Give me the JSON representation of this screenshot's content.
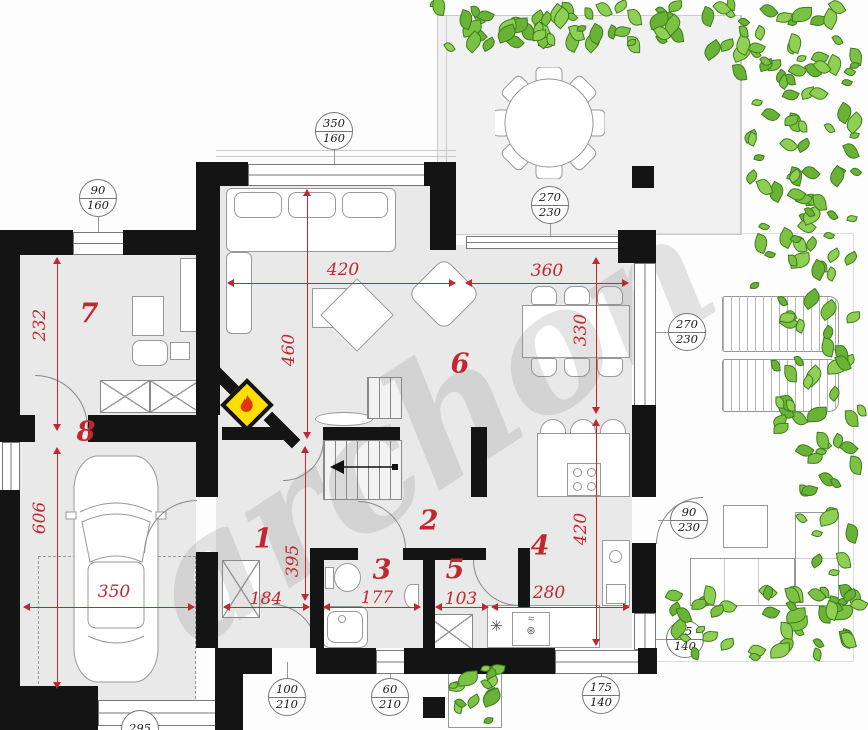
{
  "title": "House ground-floor plan",
  "watermark": "archon",
  "colors": {
    "accent_red": "#c22730",
    "wall_black": "#141414",
    "room_fill": "#e9e9e9",
    "terrace_fill": "#f1f1f1",
    "plant_green": "#7cc242",
    "plant_dark": "#3e7c1c",
    "fireplace_yellow": "#ffdf00",
    "flame_red": "#e03616",
    "line_gray": "#8a8a8a"
  },
  "room_labels": [
    {
      "n": "1",
      "x": 263,
      "y": 539
    },
    {
      "n": "2",
      "x": 429,
      "y": 521
    },
    {
      "n": "3",
      "x": 382,
      "y": 570
    },
    {
      "n": "4",
      "x": 540,
      "y": 546
    },
    {
      "n": "5",
      "x": 455,
      "y": 570
    },
    {
      "n": "6",
      "x": 460,
      "y": 364
    },
    {
      "n": "7",
      "x": 89,
      "y": 314
    },
    {
      "n": "8",
      "x": 86,
      "y": 432
    }
  ],
  "red_dims": [
    {
      "text": "420",
      "tx": 343,
      "ty": 270,
      "rot": 0,
      "dir": "h",
      "lx": 228,
      "ly": 283,
      "ll": 227
    },
    {
      "text": "460",
      "tx": 289,
      "ty": 350,
      "rot": -90,
      "dir": "v",
      "lx": 307,
      "ly": 190,
      "ll": 248
    },
    {
      "text": "360",
      "tx": 547,
      "ty": 271,
      "rot": 0,
      "dir": "h",
      "lx": 466,
      "ly": 283,
      "ll": 162
    },
    {
      "text": "330",
      "tx": 581,
      "ty": 330,
      "rot": -90,
      "dir": "v",
      "lx": 596,
      "ly": 258,
      "ll": 155
    },
    {
      "text": "420",
      "tx": 581,
      "ty": 529,
      "rot": -90,
      "dir": "v",
      "lx": 596,
      "ly": 420,
      "ll": 225
    },
    {
      "text": "280",
      "tx": 549,
      "ty": 593,
      "rot": 0,
      "dir": "h",
      "lx": 492,
      "ly": 607,
      "ll": 137
    },
    {
      "text": "103",
      "tx": 461,
      "ty": 599,
      "rot": 0,
      "dir": "h",
      "lx": 436,
      "ly": 607,
      "ll": 52
    },
    {
      "text": "177",
      "tx": 377,
      "ty": 598,
      "rot": 0,
      "dir": "h",
      "lx": 324,
      "ly": 607,
      "ll": 96
    },
    {
      "text": "184",
      "tx": 266,
      "ty": 599,
      "rot": 0,
      "dir": "h",
      "lx": 224,
      "ly": 607,
      "ll": 85
    },
    {
      "text": "395",
      "tx": 293,
      "ty": 561,
      "rot": -90,
      "dir": "v",
      "lx": 305,
      "ly": 447,
      "ll": 153
    },
    {
      "text": "232",
      "tx": 40,
      "ty": 325,
      "rot": -90,
      "dir": "v",
      "lx": 57,
      "ly": 258,
      "ll": 172
    },
    {
      "text": "606",
      "tx": 40,
      "ty": 518,
      "rot": -90,
      "dir": "v",
      "lx": 57,
      "ly": 448,
      "ll": 240
    },
    {
      "text": "350",
      "tx": 114,
      "ty": 592,
      "rot": 0,
      "dir": "h",
      "lx": 24,
      "ly": 607,
      "ll": 170
    }
  ],
  "markers": [
    {
      "top": "90",
      "bottom": "160",
      "x": 98,
      "y": 198,
      "tx": 98,
      "ty": 242
    },
    {
      "top": "350",
      "bottom": "160",
      "x": 334,
      "y": 131,
      "tx": 334,
      "ty": 174
    },
    {
      "top": "270",
      "bottom": "230",
      "x": 550,
      "y": 205,
      "tx": 550,
      "ty": 242
    },
    {
      "top": "270",
      "bottom": "230",
      "x": 687,
      "y": 332,
      "tx": 656,
      "ty": 332
    },
    {
      "top": "90",
      "bottom": "230",
      "x": 689,
      "y": 520,
      "tx": 658,
      "ty": 520
    },
    {
      "top": "95",
      "bottom": "140",
      "x": 685,
      "y": 639,
      "tx": 656,
      "ty": 633
    },
    {
      "top": "175",
      "bottom": "140",
      "x": 601,
      "y": 695,
      "tx": 601,
      "ty": 662
    },
    {
      "top": "100",
      "bottom": "210",
      "x": 287,
      "y": 697,
      "tx": 287,
      "ty": 662
    },
    {
      "top": "60",
      "bottom": "210",
      "x": 390,
      "y": 697,
      "tx": 390,
      "ty": 662
    },
    {
      "top": "295",
      "bottom": "",
      "x": 140,
      "y": 729,
      "tx": 140,
      "ty": 714
    }
  ],
  "walls": [
    [
      0,
      230,
      20,
      212
    ],
    [
      0,
      490,
      20,
      196
    ],
    [
      0,
      686,
      98,
      44
    ],
    [
      20,
      230,
      53,
      25
    ],
    [
      123,
      230,
      90,
      25
    ],
    [
      196,
      162,
      24,
      253
    ],
    [
      20,
      415,
      15,
      27
    ],
    [
      88,
      415,
      110,
      27
    ],
    [
      196,
      415,
      22,
      82
    ],
    [
      196,
      552,
      22,
      96
    ],
    [
      215,
      648,
      28,
      82
    ],
    [
      196,
      162,
      52,
      24
    ],
    [
      424,
      162,
      32,
      24
    ],
    [
      430,
      162,
      26,
      88
    ],
    [
      618,
      230,
      38,
      33
    ],
    [
      632,
      166,
      22,
      22
    ],
    [
      632,
      405,
      24,
      92
    ],
    [
      632,
      543,
      24,
      70
    ],
    [
      243,
      648,
      29,
      26
    ],
    [
      316,
      648,
      60,
      26
    ],
    [
      404,
      648,
      151,
      26
    ],
    [
      638,
      648,
      19,
      26
    ],
    [
      222,
      427,
      61,
      13
    ],
    [
      323,
      427,
      77,
      13
    ],
    [
      471,
      427,
      16,
      70
    ],
    [
      310,
      548,
      14,
      100
    ],
    [
      323,
      548,
      35,
      12
    ],
    [
      403,
      548,
      32,
      12
    ],
    [
      423,
      548,
      12,
      100
    ],
    [
      435,
      548,
      51,
      12
    ],
    [
      518,
      548,
      12,
      60
    ],
    [
      423,
      697,
      22,
      21
    ]
  ],
  "windows": [
    [
      2,
      442,
      16,
      48,
      "v"
    ],
    [
      73,
      232,
      50,
      21,
      "h"
    ],
    [
      248,
      164,
      176,
      20,
      "h"
    ],
    [
      466,
      236,
      152,
      11,
      "h"
    ],
    [
      634,
      263,
      20,
      142,
      "v"
    ],
    [
      634,
      613,
      20,
      35,
      "v"
    ],
    [
      555,
      650,
      83,
      22,
      "h"
    ],
    [
      376,
      650,
      28,
      22,
      "h"
    ],
    [
      98,
      700,
      117,
      24,
      "h"
    ]
  ],
  "doors": [
    [
      35,
      375,
      52,
      "tr"
    ],
    [
      144,
      500,
      52,
      "tl"
    ],
    [
      283,
      440,
      40,
      "br"
    ],
    [
      358,
      501,
      47,
      "tr"
    ],
    [
      473,
      560,
      45,
      "bl"
    ],
    [
      272,
      604,
      44,
      "tr"
    ],
    [
      656,
      497,
      46,
      "tl"
    ]
  ],
  "plants": [
    {
      "x": 430,
      "y": 0,
      "w": 256,
      "h": 56,
      "n": 50
    },
    {
      "x": 696,
      "y": 0,
      "w": 170,
      "h": 90,
      "n": 40
    },
    {
      "x": 742,
      "y": 85,
      "w": 124,
      "h": 210,
      "n": 55
    },
    {
      "x": 768,
      "y": 290,
      "w": 100,
      "h": 150,
      "n": 30
    },
    {
      "x": 796,
      "y": 430,
      "w": 70,
      "h": 150,
      "n": 20
    },
    {
      "x": 658,
      "y": 585,
      "w": 210,
      "h": 78,
      "n": 45
    },
    {
      "x": 448,
      "y": 660,
      "w": 58,
      "h": 68,
      "n": 14
    }
  ]
}
